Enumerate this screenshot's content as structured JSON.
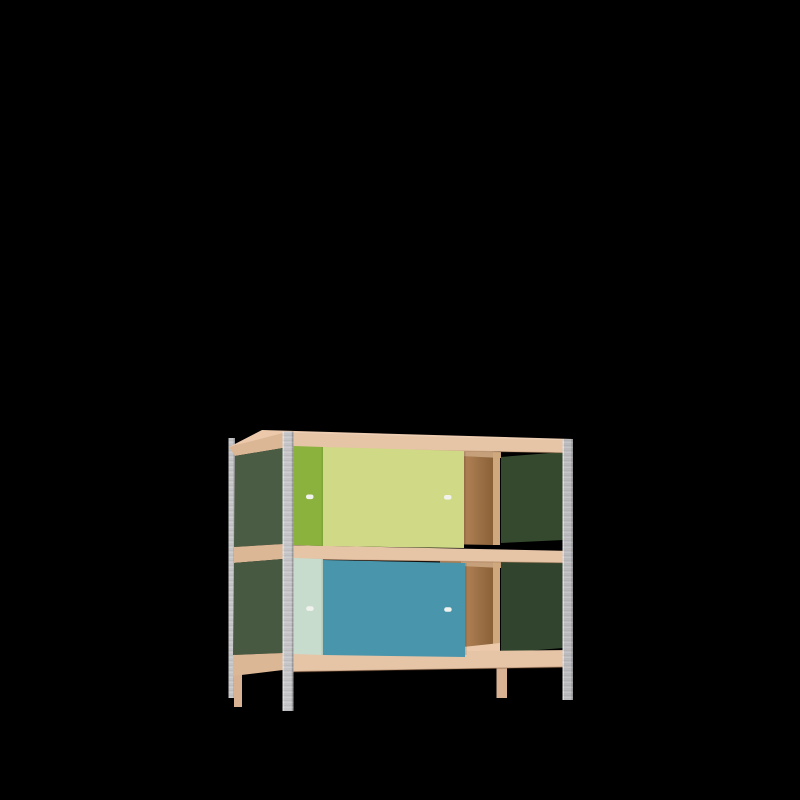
{
  "scene": {
    "object": "two-tier sideboard shelf with sliding doors",
    "view": "three-quarter front-left product render",
    "background_color": "#000000",
    "text_content": "none"
  },
  "colors": {
    "background": "#000000",
    "wood_frame": "#e6c4a6",
    "wood_top": "#ecc9ab",
    "wood_side": "#dbb796",
    "wood_leg": "#d8b292",
    "wood_underside": "#c6a07a",
    "divider_wood": "#cfa87e",
    "back_panel": "#aa7c50",
    "back_panel_dark": "#8a6138",
    "side_panel_green": "#4a5c43",
    "side_panel_green_lower": "#475941",
    "inner_panel_green": "#35492e",
    "inner_panel_green_lower": "#31442d",
    "door_green": "#8cb23e",
    "door_lime": "#d0d985",
    "door_mint": "#c7dccd",
    "door_teal": "#4995ac",
    "metal": "#c7c7c9",
    "metal_dark": "#bdbdbf",
    "metal_edge": "#9b9b9e",
    "metal_highlight": "#dedee0",
    "handle": "#f1f2ee"
  },
  "parts": [
    "galvanized-steel-corner-posts",
    "plywood-frame-rails",
    "dark-green-side-panels",
    "upper-rear-sliding-door-olive-green",
    "upper-front-sliding-door-lime",
    "lower-rear-sliding-door-mint",
    "lower-front-sliding-door-teal",
    "open-bay-with-brown-back-panel",
    "white-recessed-door-handles",
    "wood-legs"
  ]
}
